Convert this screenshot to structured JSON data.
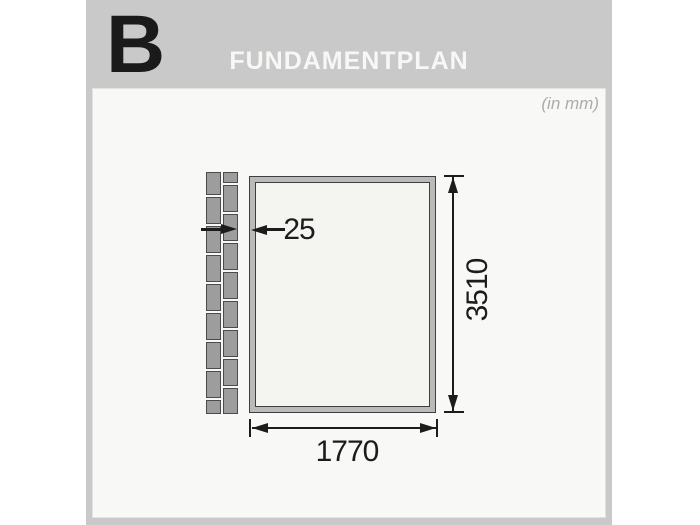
{
  "header": {
    "step_letter": "B",
    "title": "FUNDAMENTPLAN"
  },
  "panel": {
    "units_note": "(in mm)"
  },
  "drawing": {
    "type": "foundation-plan",
    "dimensions": {
      "width_label": "1770",
      "height_label": "3510",
      "offset_label": "25"
    },
    "bricks": {
      "gap": 2,
      "left_heights": [
        23,
        27,
        27,
        27,
        27,
        27,
        27,
        27,
        14
      ],
      "right_heights": [
        11,
        27,
        27,
        27,
        27,
        27,
        27,
        27,
        26
      ]
    }
  },
  "colors": {
    "card_gray": "#c9c9c9",
    "panel_bg": "#f8f8f6",
    "title_text": "#f7f7f5",
    "step_letter": "#1a1a1a",
    "brick_fill": "#9d9d9d",
    "brick_outline": "#4b4b4b",
    "frame_band": "#bababa",
    "frame_outline": "#3e3e3e",
    "dimension_ink": "#1c1c1c",
    "units_note_text": "#ababa9"
  }
}
